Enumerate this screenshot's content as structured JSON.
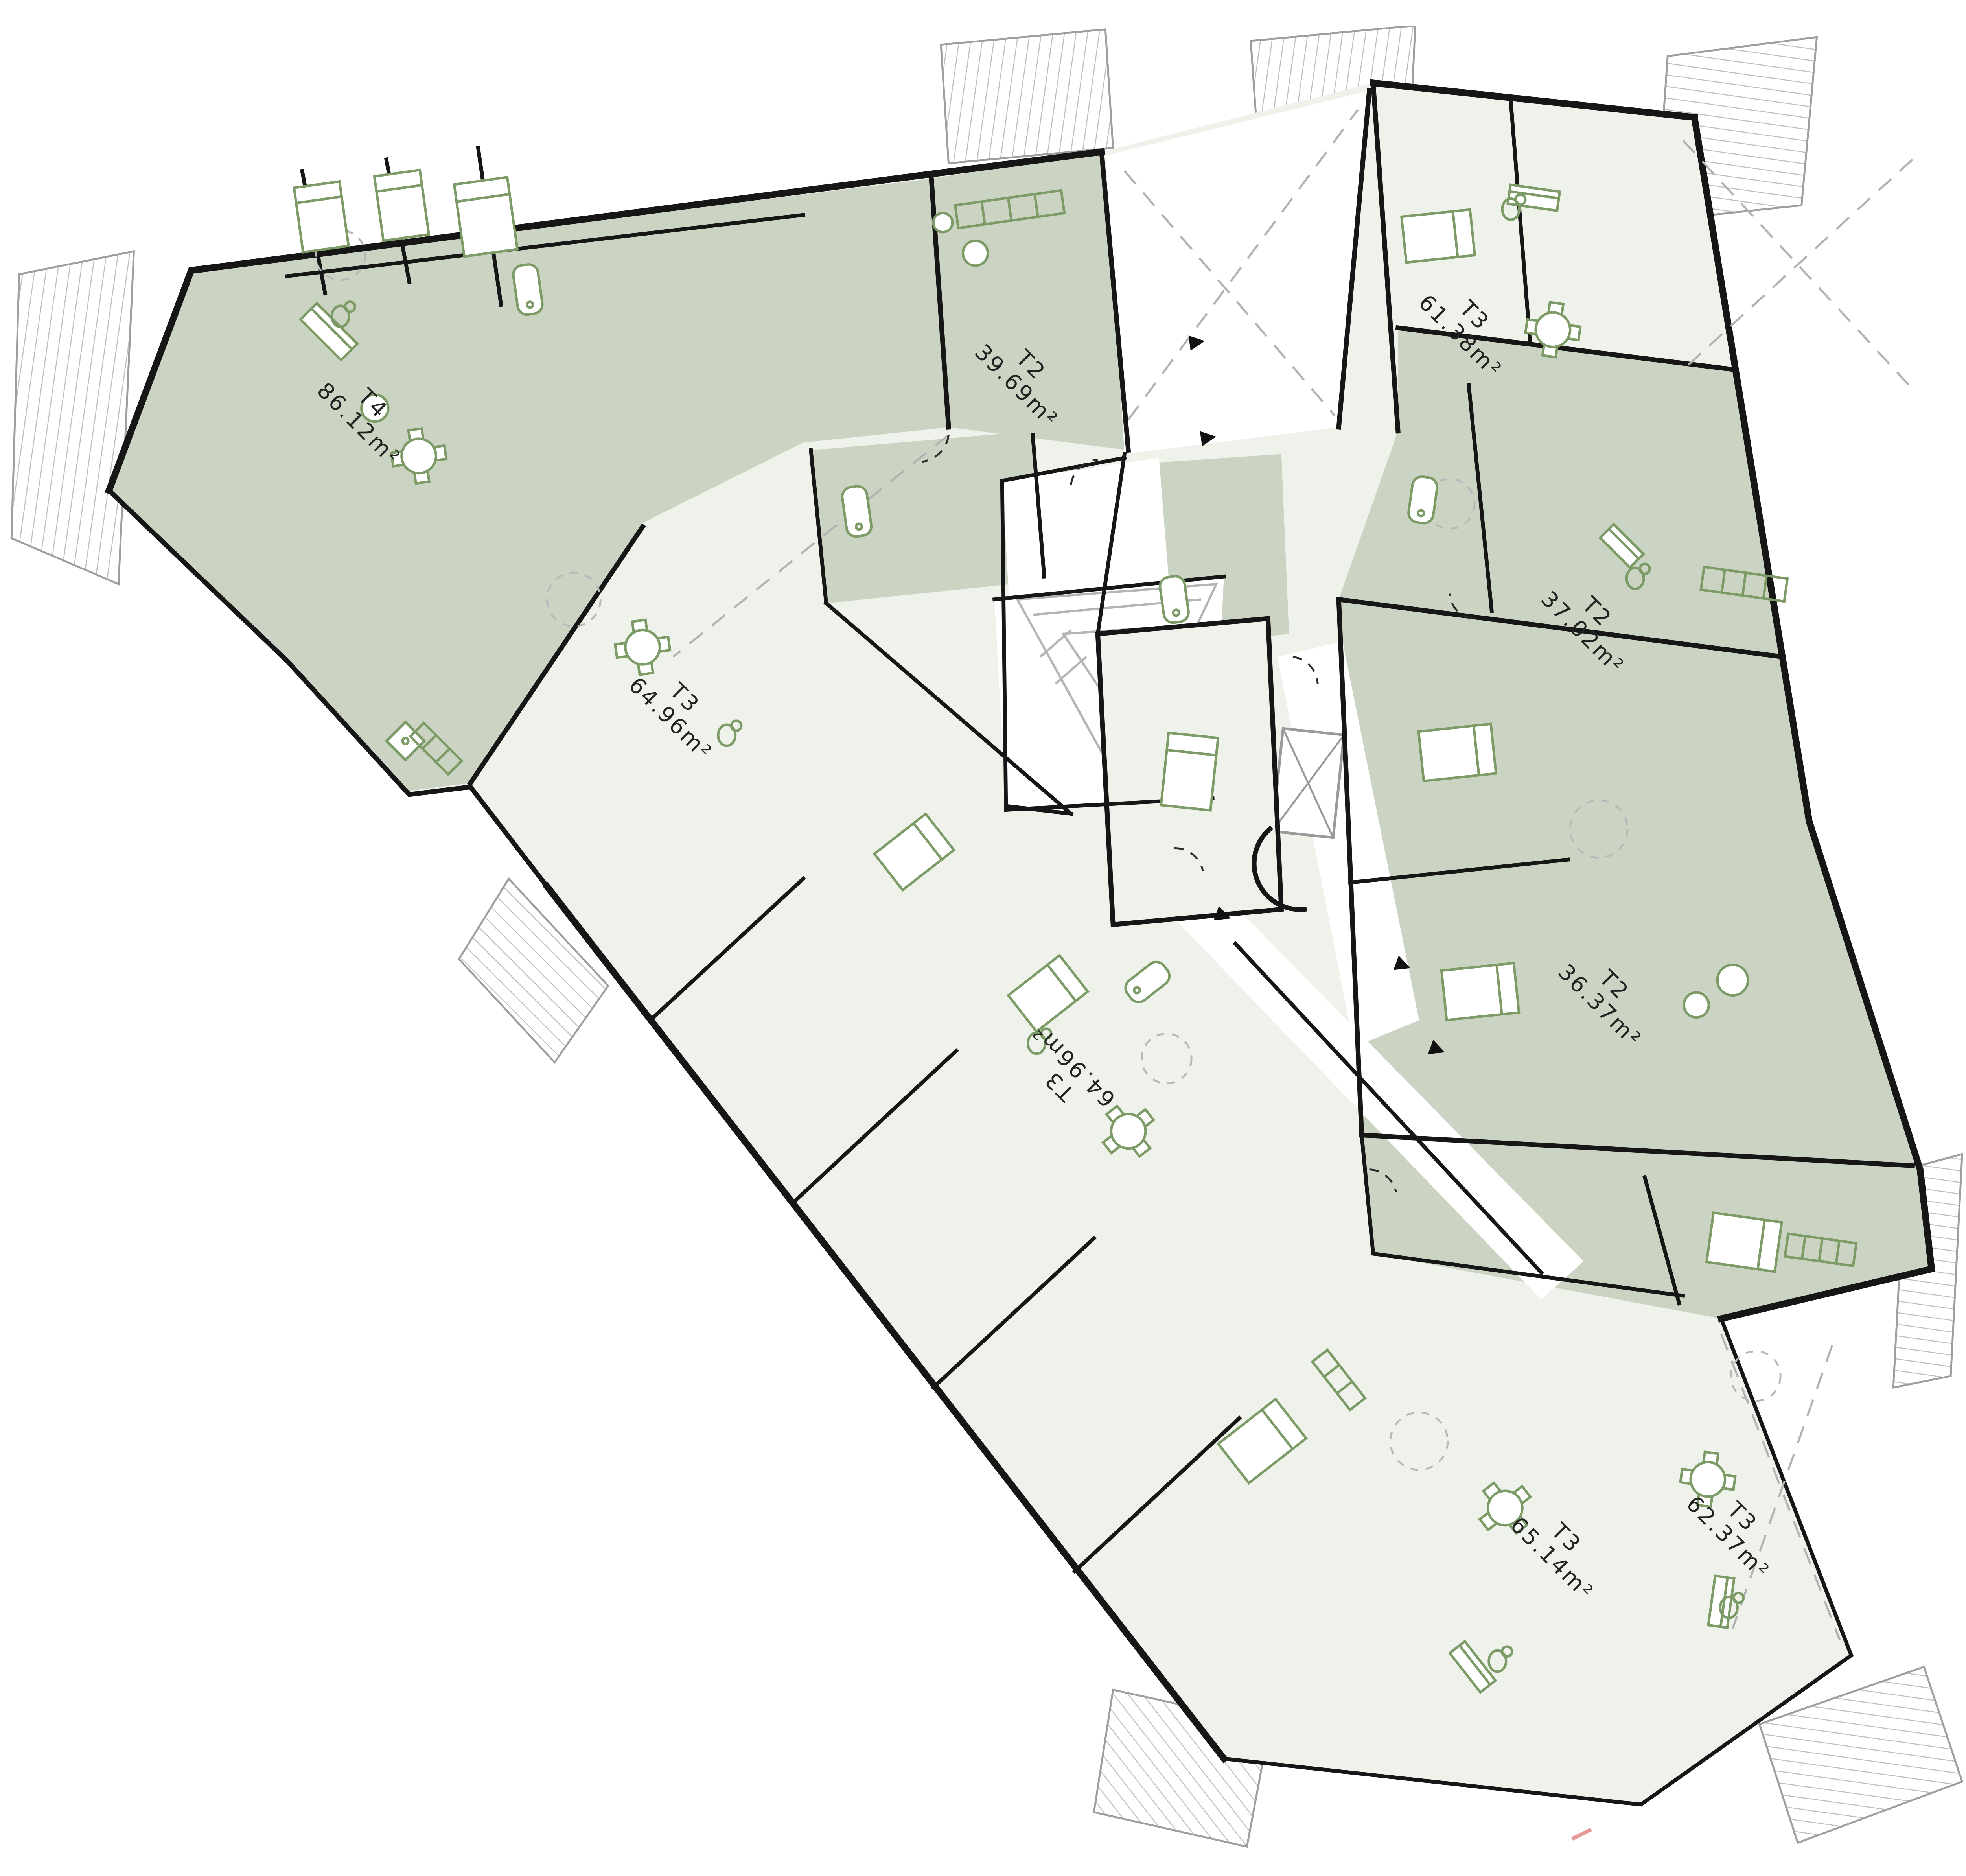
{
  "document": {
    "kind": "architectural-floor-plan",
    "description": "Apartment building storey plan with nine labelled dwelling units, shared stair core with elevator, balconies and terraces"
  },
  "colors": {
    "background": "#ffffff",
    "unit_shaded_fill": "#cbd4c3",
    "unit_light_fill": "#eef2ea",
    "circulation_fill": "#ffffff",
    "wall": "#161616",
    "furniture_outline": "#7c9b66",
    "terrace_hatch": "#c0c0c0",
    "sightline_dash": "#b3b3b3",
    "stair_outline": "#b5b5b5",
    "marker_red": "#e89a9a"
  },
  "units": [
    {
      "type": "T4",
      "area": "86.12m²",
      "shade": "shaded"
    },
    {
      "type": "T2",
      "area": "39.69m²",
      "shade": "shaded"
    },
    {
      "type": "T3",
      "area": "61.38m²",
      "shade": "light"
    },
    {
      "type": "T2",
      "area": "37.02m²",
      "shade": "shaded"
    },
    {
      "type": "T3",
      "area": "64.96m²",
      "shade": "light"
    },
    {
      "type": "T2",
      "area": "36.37m²",
      "shade": "shaded"
    },
    {
      "type": "T3",
      "area": "64.96m²",
      "shade": "light"
    },
    {
      "type": "T3",
      "area": "65.14m²",
      "shade": "light"
    },
    {
      "type": "T3",
      "area": "62.37m²",
      "shade": "light"
    }
  ]
}
